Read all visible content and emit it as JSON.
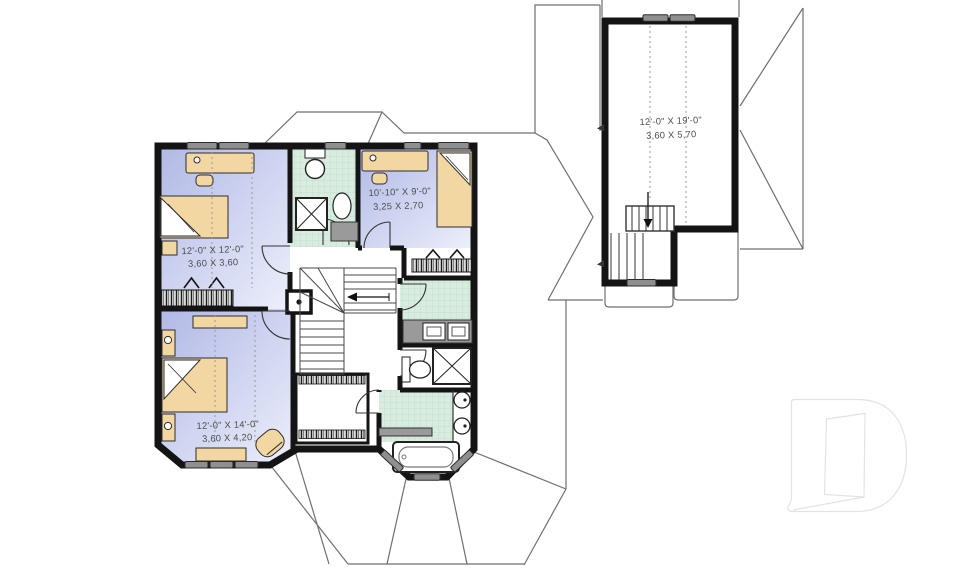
{
  "title": "second-floor-plan",
  "colors": {
    "wall": "#141414",
    "bedroom_floor": "#b4bbe6",
    "bedroom_floor_light": "#edeffb",
    "tile": "#d8ecdf",
    "tile_line": "#c2dfd0",
    "furniture": "#f3d7a2",
    "window": "#8f8f8f",
    "roof_line": "#6f6f6f",
    "counter": "#9a9a9a",
    "text": "#4e4e4e",
    "logo_outline": "#e3e3e3"
  },
  "rooms": [
    {
      "name": "bedroom-top-left",
      "imperial": "12'-0\" X 12'-0\"",
      "metric": "3,60 X 3,60"
    },
    {
      "name": "bedroom-top-right",
      "imperial": "10'-10\" X 9'-0\"",
      "metric": "3,25 X 2,70"
    },
    {
      "name": "bedroom-bottom-left",
      "imperial": "12'-0\" X 14'-0\"",
      "metric": "3,60 X 4,20"
    },
    {
      "name": "bonus-room",
      "imperial": "12'-0\" X 19'-0\"",
      "metric": "3,60 X 5,70"
    }
  ]
}
